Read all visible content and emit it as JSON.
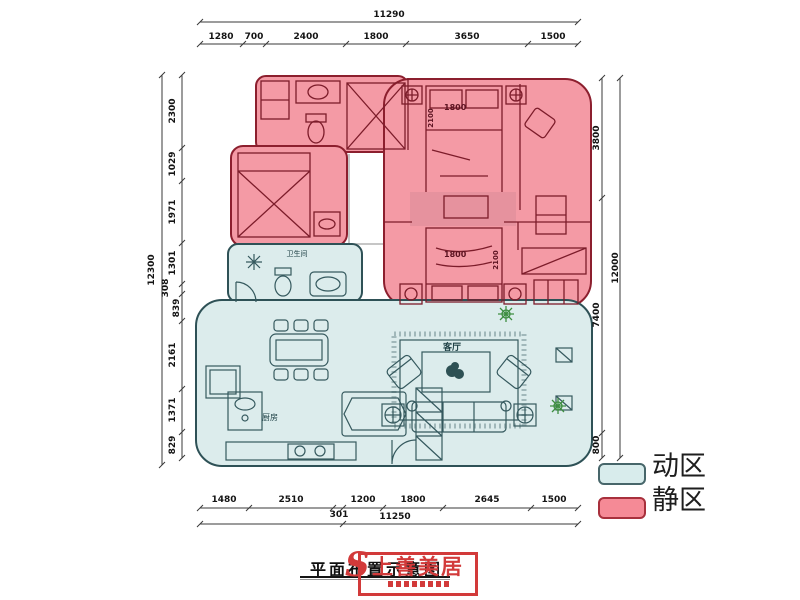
{
  "dimensions": {
    "top": {
      "total": "11290",
      "segments": [
        "1280",
        "700",
        "2400",
        "1800",
        "3650",
        "1500"
      ]
    },
    "bottom": {
      "segments": [
        "1480",
        "2510",
        "1200",
        "1800",
        "2645",
        "1500"
      ],
      "offset": "301",
      "total": "11250"
    },
    "left": {
      "total": "12300",
      "segments": [
        "2300",
        "1029",
        "1971",
        "1301",
        "308",
        "839",
        "2161",
        "1371",
        "829"
      ]
    },
    "right": {
      "total": "12000",
      "segments": [
        "3800",
        "7400",
        "800"
      ]
    }
  },
  "rooms": {
    "bathroom": "卫生间",
    "living_room": "客厅",
    "kitchen": "厨房"
  },
  "furniture_labels": {
    "master_bed_width": "1800",
    "master_bed_length": "2100",
    "second_bed_width": "1800",
    "second_bed_length": "2100"
  },
  "legend": {
    "items": [
      {
        "label": "动区",
        "color": "#d8ecec"
      },
      {
        "label": "静区",
        "color": "#f58a96"
      }
    ]
  },
  "footer": {
    "caption": "平面布置示意图",
    "stamp": "上善美居"
  },
  "colors": {
    "quiet_zone_fill": "#f49aa5",
    "quiet_zone_stroke": "#8c1f2e",
    "active_zone_fill": "#dcecec",
    "active_zone_stroke": "#2e5156",
    "stamp_red": "#d23a3a"
  }
}
